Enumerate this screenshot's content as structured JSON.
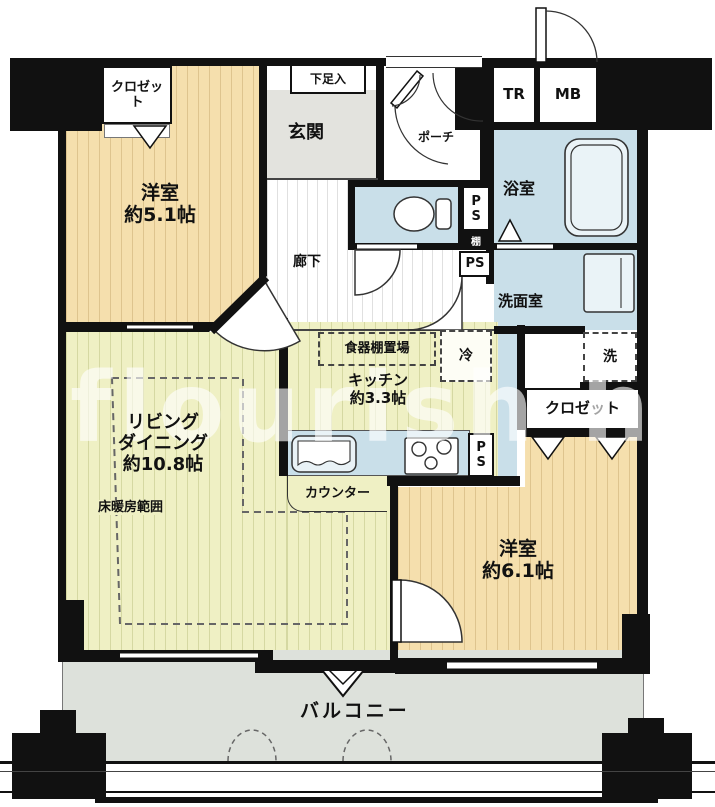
{
  "colors": {
    "wall": "#111111",
    "tatami_floor": "#F5DFAD",
    "living_floor": "#EFF0C4",
    "wet_area_floor": "#C9DFE9",
    "entrance_floor": "#E3E3DE",
    "balcony_floor": "#DDE1DB"
  },
  "watermark": "flourish hous",
  "rooms": {
    "bedroom_small": {
      "name": "洋室",
      "size": "約5.1帖"
    },
    "bedroom_large": {
      "name": "洋室",
      "size": "約6.1帖"
    },
    "living_dining": {
      "name_line1": "リビング",
      "name_line2": "ダイニング",
      "size": "約10.8帖"
    },
    "kitchen": {
      "name": "キッチン",
      "size": "約3.3帖"
    },
    "bathroom": {
      "name": "浴室"
    },
    "washroom": {
      "name": "洗面室"
    },
    "entrance": {
      "name": "玄関"
    },
    "porch": {
      "name": "ポーチ"
    },
    "hallway": {
      "name": "廊下"
    },
    "balcony": {
      "name": "バルコニー"
    }
  },
  "fixtures": {
    "closet_top_left": "クロゼット",
    "closet_right": "クロゼット",
    "shoe_cabinet": "下足入",
    "cupboard_space": "食器棚置場",
    "refrigerator_space": "冷",
    "washer_space": "洗",
    "shelf": "棚",
    "counter": "カウンター",
    "floor_heating_area": "床暖房範囲",
    "trunk_room": "TR",
    "meter_box": "MB",
    "pipe_space": "PS"
  }
}
